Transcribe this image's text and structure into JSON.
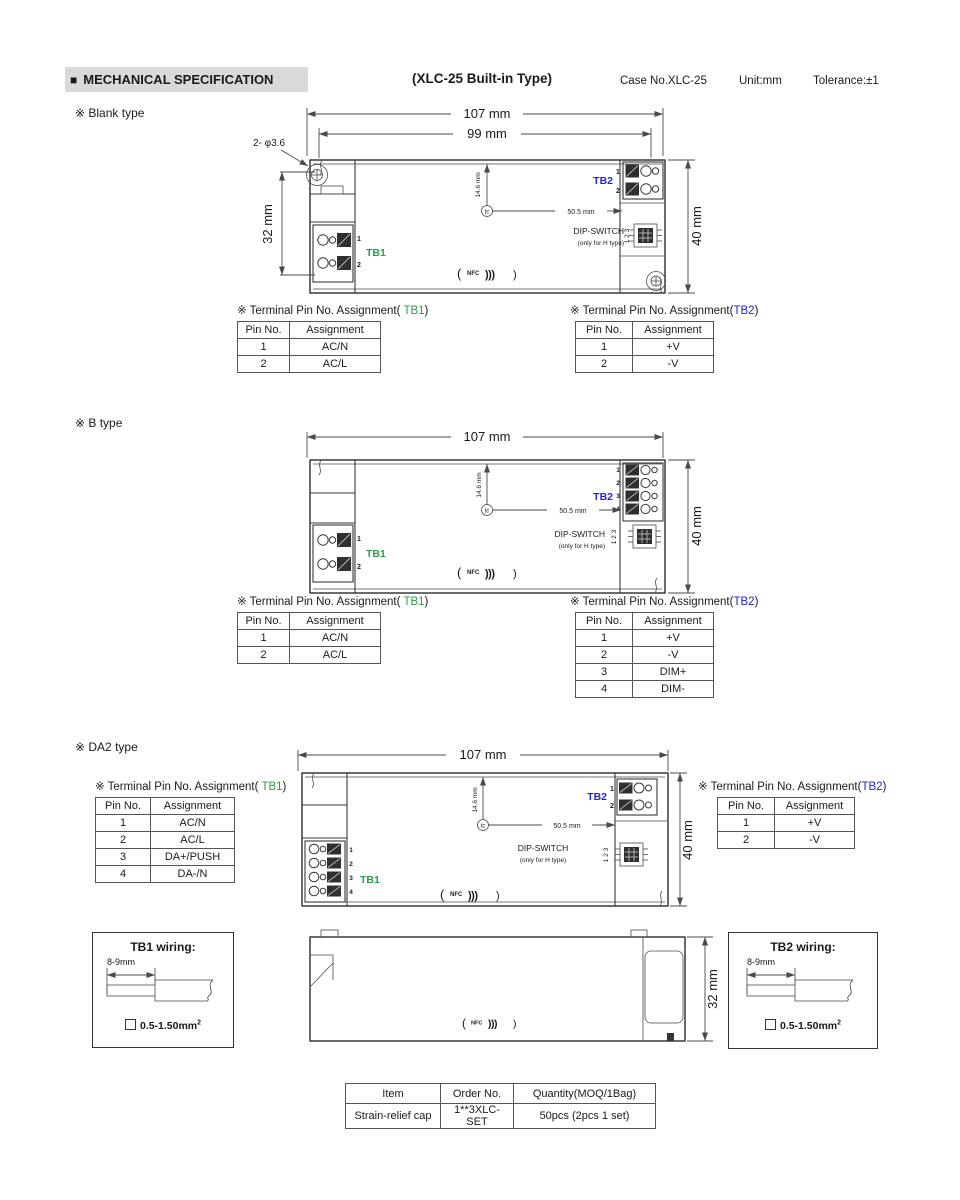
{
  "header": {
    "bullet": "■",
    "title": "MECHANICAL SPECIFICATION",
    "subtitle": "(XLC-25 Built-in Type)",
    "case_no": "Case No.XLC-25",
    "unit": "Unit:mm",
    "tolerance": "Tolerance:±1"
  },
  "sections": {
    "blank_label": "※ Blank type",
    "b_label": "※ B type",
    "da2_label": "※ DA2 type"
  },
  "drawing": {
    "dim_107": "107 mm",
    "dim_99": "99 mm",
    "dim_32": "32 mm",
    "dim_40": "40 mm",
    "hole": "2- φ3.6",
    "tc_sym": "tc",
    "dim_146": "14.6 mm",
    "dim_505": "50.5 mm",
    "tb1": "TB1",
    "tb2": "TB2",
    "dip_switch": "DIP-SWITCH",
    "dip_note": "(only for H type)",
    "dip_pins": "1 2 3",
    "nfc_open": "(",
    "nfc": "NFC",
    "nfc_arcs": ")))",
    "nfc_close": ")",
    "p1": "1",
    "p2": "2",
    "p3": "3",
    "p4": "4"
  },
  "tables": {
    "title_prefix": "※ Terminal Pin No. Assignment(",
    "tb1_name": " TB1",
    "tb2_name": "TB2",
    "title_suffix": ")",
    "pin_headers": [
      [
        "Pin No.",
        "Assignment"
      ]
    ],
    "blank_tb1_rows": [
      [
        "1",
        "AC/N"
      ],
      [
        "2",
        "AC/L"
      ]
    ],
    "blank_tb2_rows": [
      [
        "1",
        "+V"
      ],
      [
        "2",
        "-V"
      ]
    ],
    "b_tb1_rows": [
      [
        "1",
        "AC/N"
      ],
      [
        "2",
        "AC/L"
      ]
    ],
    "b_tb2_rows": [
      [
        "1",
        "+V"
      ],
      [
        "2",
        "-V"
      ],
      [
        "3",
        "DIM+"
      ],
      [
        "4",
        "DIM-"
      ]
    ],
    "da2_tb1_rows": [
      [
        "1",
        "AC/N"
      ],
      [
        "2",
        "AC/L"
      ],
      [
        "3",
        "DA+/PUSH"
      ],
      [
        "4",
        "DA-/N"
      ]
    ],
    "da2_tb2_rows": [
      [
        "1",
        "+V"
      ],
      [
        "2",
        "-V"
      ]
    ]
  },
  "wiring": {
    "tb1_title": "TB1 wiring:",
    "tb2_title": "TB2 wiring:",
    "strip_len": "8-9mm",
    "gauge": "0.5-1.50mm",
    "gauge_sup": "2"
  },
  "order_table": {
    "headers": [
      [
        "Item",
        "Order No.",
        "Quantity(MOQ/1Bag)"
      ]
    ],
    "rows": [
      [
        "Strain-relief cap",
        "1**3XLC-SET",
        "50pcs (2pcs 1 set)"
      ]
    ]
  },
  "colors": {
    "tb1_green": "#2e9b4e",
    "tb2_blue": "#2626cc",
    "nfc_blue": "#1857c8",
    "header_highlight": "#d9d9d9"
  }
}
